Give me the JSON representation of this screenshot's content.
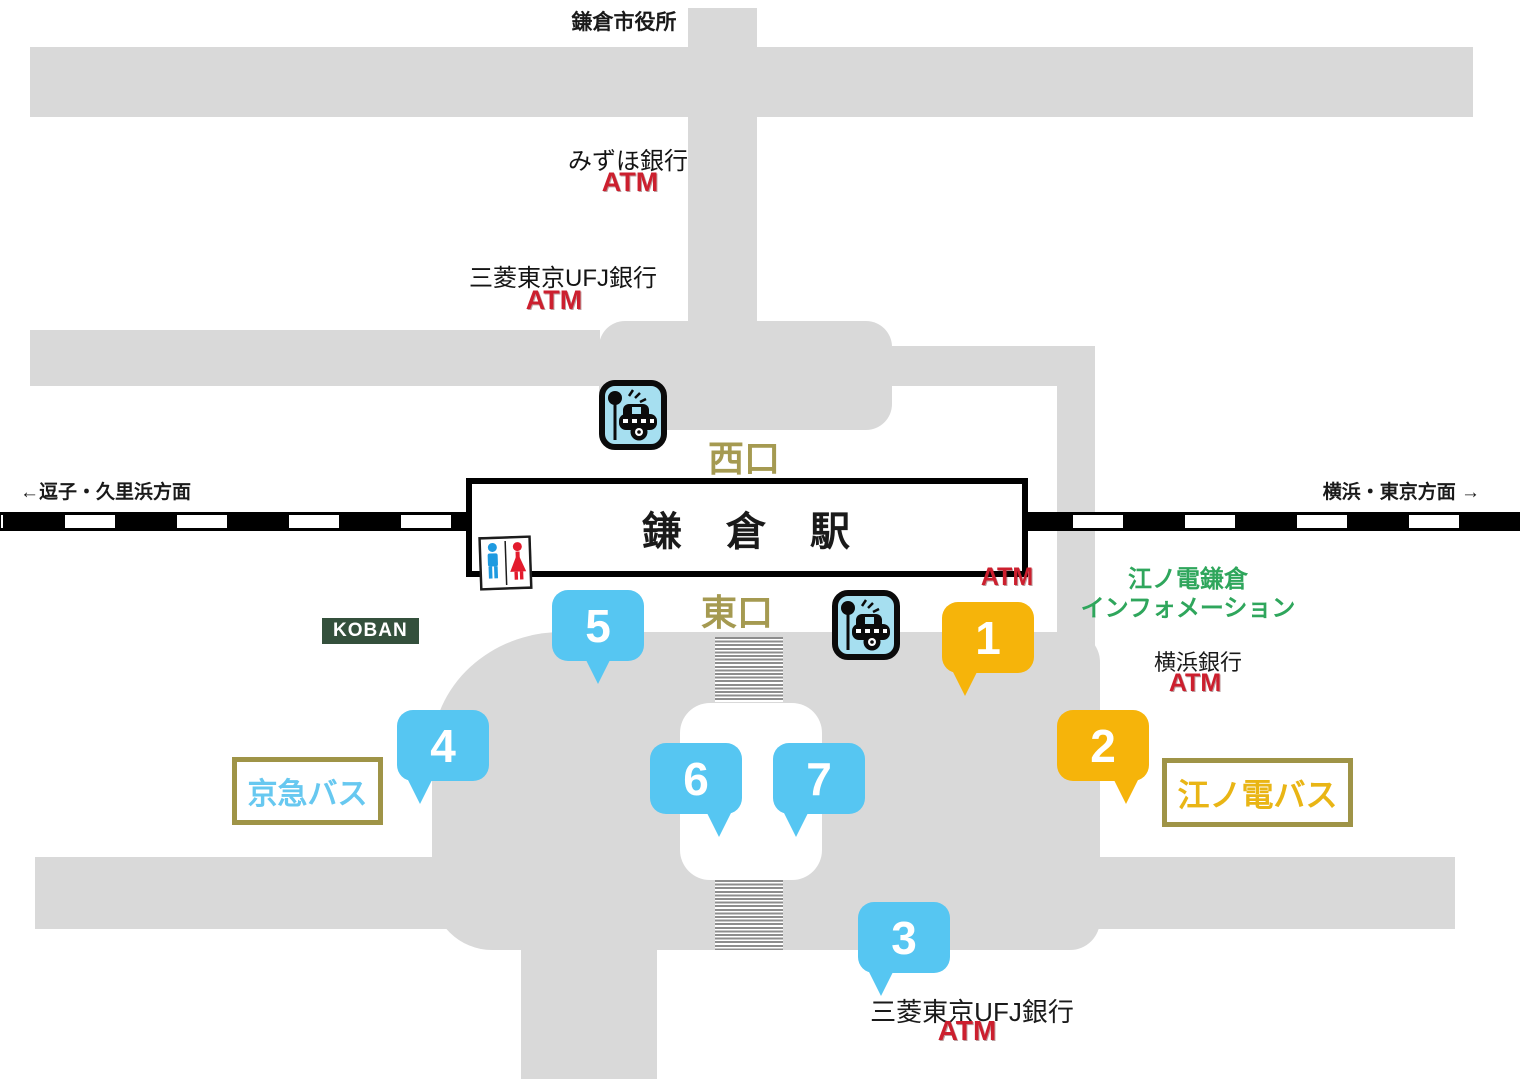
{
  "station": {
    "name": "鎌　倉　駅"
  },
  "exits": {
    "west": "西口",
    "east": "東口"
  },
  "rail_directions": {
    "west": "←逗子・久里浜方面",
    "east": "横浜・東京方面 →"
  },
  "landmarks": {
    "city_hall": "鎌倉市役所",
    "mizuho_bank": "みずほ銀行",
    "mizuho_bank_atm": "ATM",
    "mufg_bank_west": "三菱東京UFJ銀行",
    "mufg_bank_west_atm": "ATM",
    "station_east_atm": "ATM",
    "enoden_info_line1": "江ノ電鎌倉",
    "enoden_info_line2": "インフォメーション",
    "yokohama_bank": "横浜銀行",
    "yokohama_bank_atm": "ATM",
    "mufg_bank_south": "三菱東京UFJ銀行",
    "mufg_bank_south_atm": "ATM",
    "koban": "KOBAN"
  },
  "bus_companies": {
    "keikyu": "京急バス",
    "enoden": "江ノ電バス"
  },
  "bus_stops": [
    {
      "number": "1",
      "color": "orange"
    },
    {
      "number": "2",
      "color": "orange"
    },
    {
      "number": "3",
      "color": "blue"
    },
    {
      "number": "4",
      "color": "blue"
    },
    {
      "number": "5",
      "color": "blue"
    },
    {
      "number": "6",
      "color": "blue"
    },
    {
      "number": "7",
      "color": "blue"
    }
  ],
  "icons": {
    "taxi_stand_west": "taxi-stand",
    "taxi_stand_east": "taxi-stand",
    "restroom": "restroom"
  },
  "colors": {
    "road_gray": "#d9d9d9",
    "stop_blue": "#56c6f2",
    "stop_orange": "#f6b40a",
    "atm_red": "#cc1f2e",
    "exit_text_olive": "#a59a51",
    "info_green": "#2fa65c",
    "koban_bg": "#34503c",
    "keikyu_text": "#67c8f0",
    "enoden_text": "#e9b515",
    "sign_border": "#9f9447"
  }
}
